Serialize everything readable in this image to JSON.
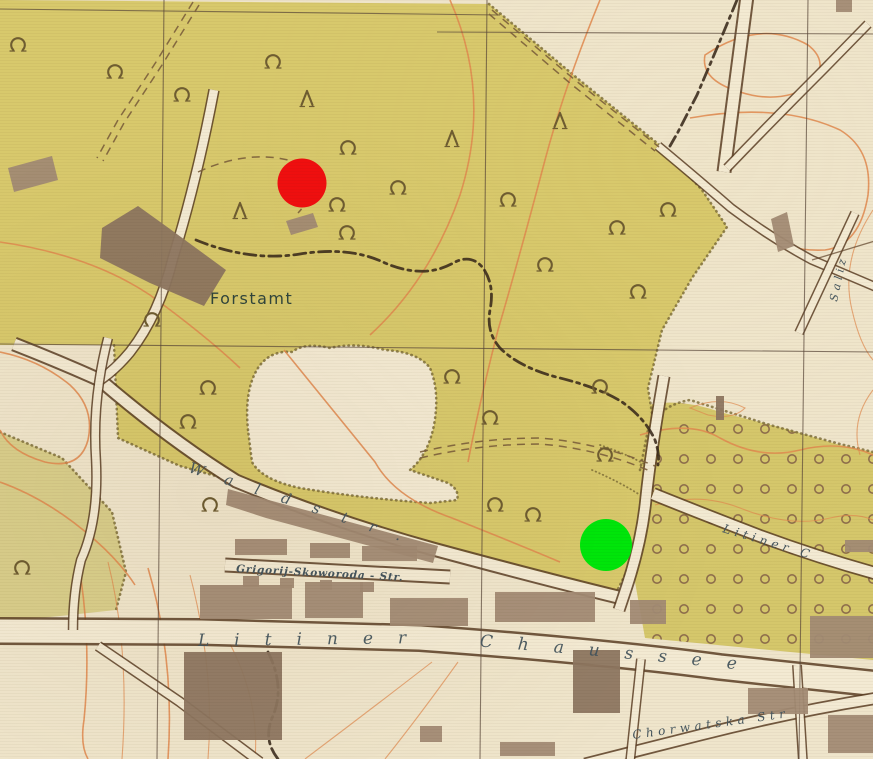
{
  "title": "Historical town map scan with two overlay location markers",
  "map": {
    "labels": {
      "forstamt": "Forstamt",
      "waldstrasse": "Waldstr.",
      "grigorij_skoworoda_str": "Grigorij-Skoworoda - Str.",
      "litiner_chaussee": "Litiner Chaussee",
      "litiner_c": "Litiner C",
      "chorwatska_str": "Chorwatska Str",
      "saliz": "Saliz"
    },
    "symbols": {
      "deciduous_tree": "open-ring-tree-icon",
      "conifer_tree": "lambda-tree-icon",
      "orchard": "rows-of-small-circles"
    }
  },
  "markers": [
    {
      "name": "red-marker",
      "color": "#F00F0F",
      "x": 302,
      "y": 183,
      "r": 24.5
    },
    {
      "name": "green-marker",
      "color": "#00E70A",
      "x": 606,
      "y": 545,
      "r": 26
    }
  ],
  "colors": {
    "paper": "#EFE5CB",
    "road_fill": "#F3EAD3",
    "forest": "#D8C96C",
    "forest_light": "#D9CE8B",
    "orchard": "#D5C76B",
    "building": "#A28B74",
    "building_dark": "#8D7660",
    "road_casing": "#5C4026",
    "contour": "#E08A4F",
    "grid": "#5A4739",
    "boundary": "#39291A",
    "track": "#7C5F3C",
    "tree": "#6F5D31",
    "orchard_ring": "#8F6F4C",
    "stipple": "#7B6A35",
    "street_ink": "#46565E",
    "forstamt_ink": "#31463C"
  }
}
